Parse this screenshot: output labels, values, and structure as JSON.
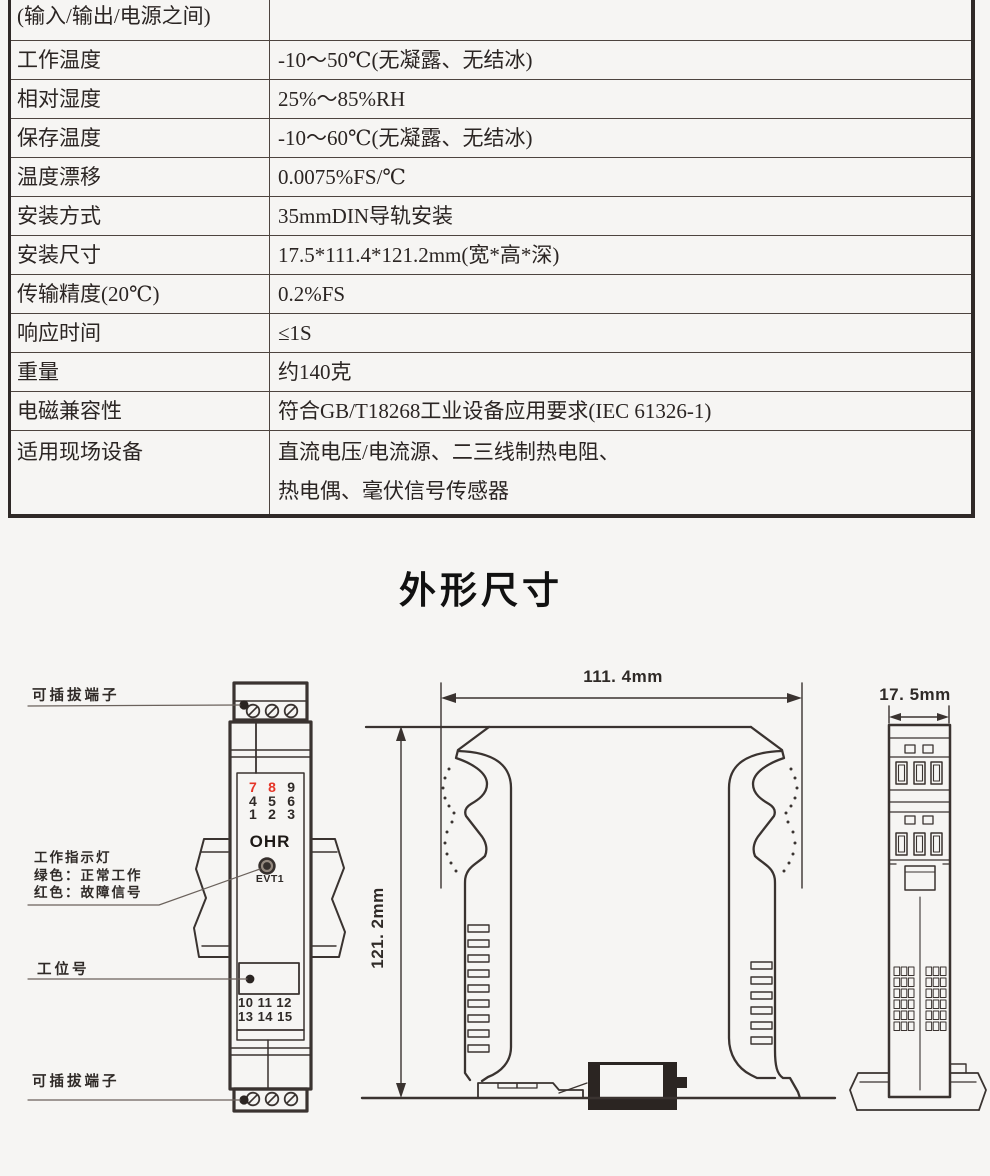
{
  "page": {
    "background": "#f6f5f3",
    "line_color": "#3a3330",
    "accent_red": "#e53527"
  },
  "spec_table": {
    "rows": [
      {
        "label": "(输入/输出/电源之间)",
        "value": ""
      },
      {
        "label": "工作温度",
        "value": "-10～50℃(无凝露、无结冰)"
      },
      {
        "label": "相对湿度",
        "value": "25%～85%RH"
      },
      {
        "label": "保存温度",
        "value": "-10～60℃(无凝露、无结冰)"
      },
      {
        "label": "温度漂移",
        "value": "0.0075%FS/℃"
      },
      {
        "label": "安装方式",
        "value": "35mmDIN导轨安装"
      },
      {
        "label": "安装尺寸",
        "value": "17.5*111.4*121.2mm(宽*高*深)"
      },
      {
        "label": "传输精度(20℃)",
        "value": "0.2%FS"
      },
      {
        "label": "响应时间",
        "value": "≤1S"
      },
      {
        "label": "重量",
        "value": "约140克"
      },
      {
        "label": "电磁兼容性",
        "value": "符合GB/T18268工业设备应用要求(IEC 61326-1)"
      },
      {
        "label": "适用现场设备",
        "value": "直流电压/电流源、二三线制热电阻、",
        "value_line2": "热电偶、毫伏信号传感器"
      }
    ]
  },
  "section_title": "外形尺寸",
  "front_view": {
    "label_top_terminal": "可插拔端子",
    "indicator_label_line1": "工作指示灯",
    "indicator_label_line2": "绿色：正常工作",
    "indicator_label_line3": "红色：故障信号",
    "label_station": "工位号",
    "label_bottom_terminal": "可插拔端子",
    "terminal_numbers_top": [
      [
        "7",
        "8",
        "9"
      ],
      [
        "4",
        "5",
        "6"
      ],
      [
        "1",
        "2",
        "3"
      ]
    ],
    "brand": "OHR",
    "led_label": "EVT1",
    "terminal_numbers_bottom": [
      "10 11 12",
      "13 14 15"
    ]
  },
  "side_view": {
    "width_dim": "111. 4mm",
    "height_dim": "121. 2mm"
  },
  "end_view": {
    "depth_dim": "17. 5mm"
  }
}
